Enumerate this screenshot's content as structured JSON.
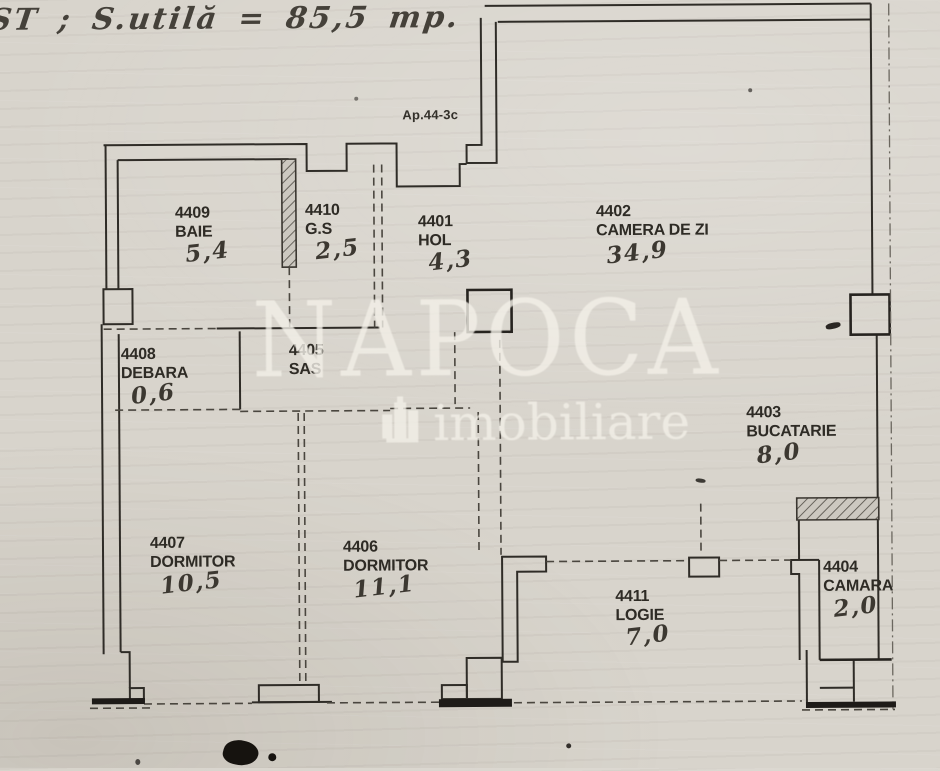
{
  "meta": {
    "title_handwritten": "ST ;  S.utilă = 85,5 mp.",
    "apartment_ref": "Ap.44-3c"
  },
  "watermark": {
    "name": "NAPOCA",
    "subtitle": "imobiliare"
  },
  "colors": {
    "paper": "#d8d4cc",
    "line": "#2f2c27",
    "watermark_text": "#f3f0e8",
    "artifact": "#16130f"
  },
  "rooms": [
    {
      "id": "4409",
      "name": "BAIE",
      "area": "5,4"
    },
    {
      "id": "4410",
      "name": "G.S",
      "area": "2,5"
    },
    {
      "id": "4401",
      "name": "HOL",
      "area": "4,3"
    },
    {
      "id": "4402",
      "name": "CAMERA DE ZI",
      "area": "34,9"
    },
    {
      "id": "4408",
      "name": "DEBARA",
      "area": "0,6"
    },
    {
      "id": "4405",
      "name": "SAS",
      "area": ""
    },
    {
      "id": "4403",
      "name": "BUCATARIE",
      "area": "8,0"
    },
    {
      "id": "4404",
      "name": "CAMARA",
      "area": "2,0"
    },
    {
      "id": "4407",
      "name": "DORMITOR",
      "area": "10,5"
    },
    {
      "id": "4406",
      "name": "DORMITOR",
      "area": "11,1"
    },
    {
      "id": "4411",
      "name": "LOGIE",
      "area": "7,0"
    }
  ]
}
